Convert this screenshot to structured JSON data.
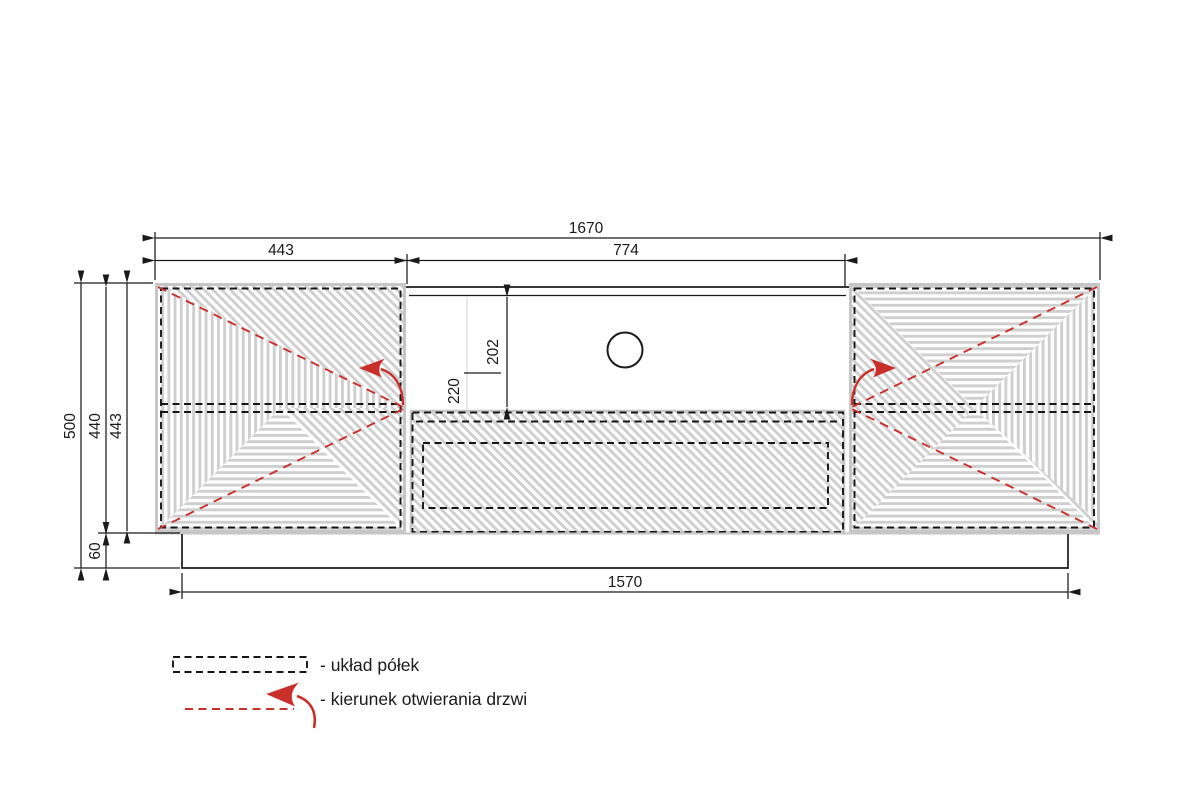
{
  "drawing": {
    "title": "TV cabinet front technical drawing",
    "dims": {
      "total_width": "1670",
      "left_door_width": "443",
      "middle_width": "774",
      "overall_height": "500",
      "body_height": "440",
      "door_height": "443",
      "plinth_height": "60",
      "plinth_width": "1570",
      "niche_height": "202",
      "drawer_height": "220"
    },
    "features": {
      "cable_hole": "circle",
      "shelf_lines": "dashed",
      "door_count": 2,
      "drawer_count": 1
    }
  },
  "legend": {
    "shelves": "- układ półek",
    "doors": "- kierunek otwierania drzwi"
  },
  "colors": {
    "line": "#1a1a1a",
    "red": "#c9302c",
    "hatch": "#cfcfcf",
    "panel_edge": "#c6c6c6"
  }
}
